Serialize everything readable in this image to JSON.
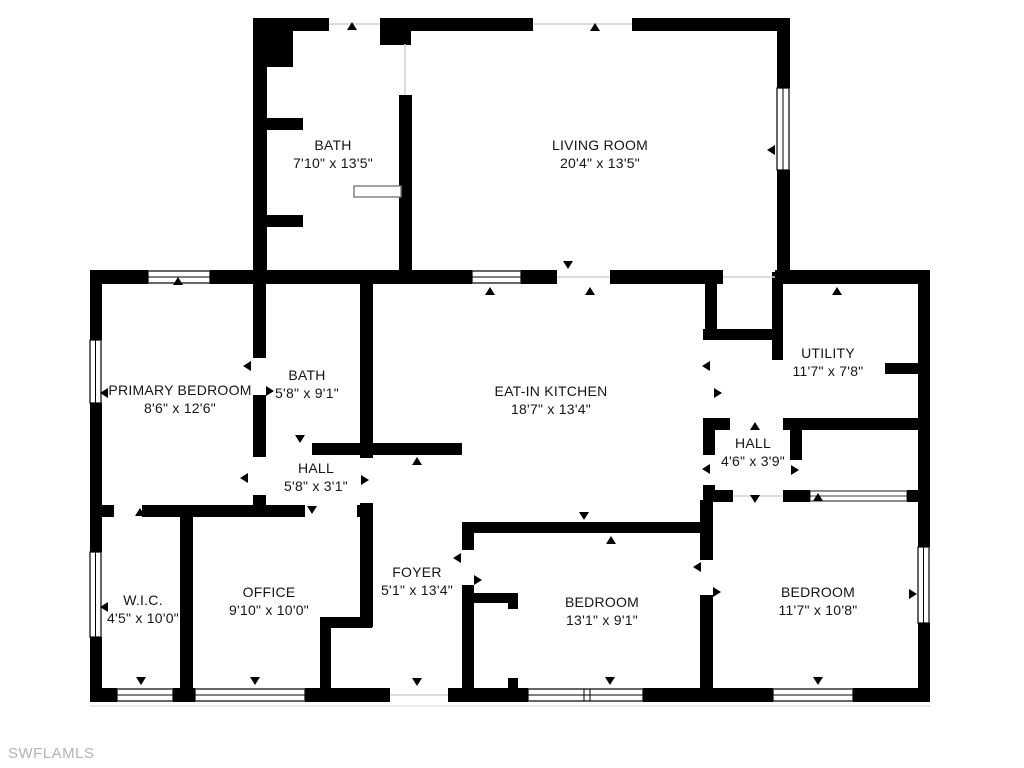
{
  "watermark": "SWFLAMLS",
  "colors": {
    "wall": "#000000",
    "background": "#ffffff",
    "watermark": "#b3b3b3"
  },
  "rooms": [
    {
      "id": "bath-upper",
      "name": "BATH",
      "dims": "7'10\" x 13'5\""
    },
    {
      "id": "living-room",
      "name": "LIVING ROOM",
      "dims": "20'4\" x 13'5\""
    },
    {
      "id": "primary-bedroom",
      "name": "PRIMARY BEDROOM",
      "dims": "8'6\" x 12'6\""
    },
    {
      "id": "bath-middle",
      "name": "BATH",
      "dims": "5'8\" x 9'1\""
    },
    {
      "id": "eat-in-kitchen",
      "name": "EAT-IN KITCHEN",
      "dims": "18'7\" x 13'4\""
    },
    {
      "id": "utility",
      "name": "UTILITY",
      "dims": "11'7\" x 7'8\""
    },
    {
      "id": "hall-middle",
      "name": "HALL",
      "dims": "5'8\" x 3'1\""
    },
    {
      "id": "hall-right",
      "name": "HALL",
      "dims": "4'6\" x 3'9\""
    },
    {
      "id": "wic",
      "name": "W.I.C.",
      "dims": "4'5\" x 10'0\""
    },
    {
      "id": "office",
      "name": "OFFICE",
      "dims": "9'10\" x 10'0\""
    },
    {
      "id": "foyer",
      "name": "FOYER",
      "dims": "5'1\" x 13'4\""
    },
    {
      "id": "bedroom-center",
      "name": "BEDROOM",
      "dims": "13'1\" x 9'1\""
    },
    {
      "id": "bedroom-right",
      "name": "BEDROOM",
      "dims": "11'7\" x 10'8\""
    }
  ]
}
